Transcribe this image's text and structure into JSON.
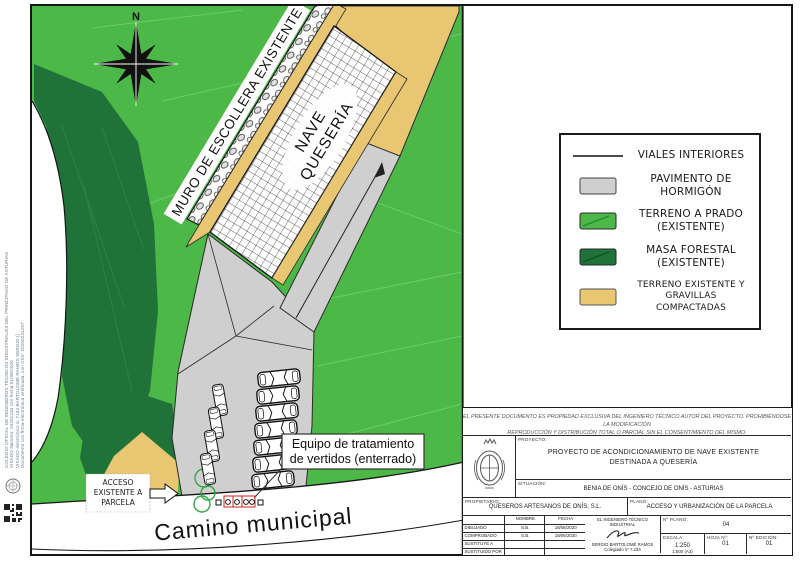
{
  "colors": {
    "prado": "#4cb848",
    "forestal": "#1f7238",
    "gravilla": "#e9c672",
    "hormigon": "#cfcfcf",
    "road": "#ffffff"
  },
  "map": {
    "north_label": "N",
    "muro_label": "MURO DE ESCOLLERA EXISTENTE",
    "nave_line1": "NAVE",
    "nave_line2": "QUESERÍA",
    "equipo_line1": "Equipo de tratamiento",
    "equipo_line2": "de vertidos (enterrado)",
    "acceso_line1": "ACCESO",
    "acceso_line2": "EXISTENTE A",
    "acceso_line3": "PARCELA",
    "camino_label": "Camino municipal"
  },
  "legend": {
    "items": [
      {
        "line1": "VIALES INTERIORES",
        "line2": ""
      },
      {
        "line1": "PAVIMENTO DE",
        "line2": "HORMIGÓN"
      },
      {
        "line1": "TERRENO A PRADO",
        "line2": "(EXISTENTE)"
      },
      {
        "line1": "MASA FORESTAL",
        "line2": "(EXISTENTE)"
      },
      {
        "line1": "TERRENO EXISTENTE Y",
        "line2": "GRAVILLAS COMPACTADAS"
      }
    ]
  },
  "title_block": {
    "disclaimer_line1": "EL PRESENTE DOCUMENTO ES PROPIEDAD EXCLUSIVA DEL INGENIERO TÉCNICO AUTOR DEL PROYECTO. PROHIBIÉNDOSE LA MODIFICACIÓN",
    "disclaimer_line2": "REPRODUCCIÓN Y DISTRIBUCIÓN TOTAL O PARCIAL SIN EL CONSENTIMIENTO DEL MISMO.",
    "proyecto_label": "PROYECTO:",
    "proyecto_line1": "PROYECTO DE ACONDICIONAMIENTO DE NAVE EXISTENTE",
    "proyecto_line2": "DESTINADA A QUESERÍA",
    "situacion_label": "SITUACIÓN:",
    "situacion_value": "BENIA DE ONÍS - CONCEJO DE ONÍS - ASTURIAS",
    "propietario_label": "PROPIETARIO:",
    "propietario_value": "QUESEROS ARTESANOS DE ONÍS, S.L.",
    "plano_label": "PLANO:",
    "plano_value": "ACCESO Y URBANIZACIÓN DE LA PARCELA",
    "col_nombre": "NOMBRE",
    "col_fecha": "FECHA",
    "rows": [
      {
        "label": "DIBUJADO",
        "nombre": "S.B.",
        "fecha": "18/06/2020"
      },
      {
        "label": "COMPROBADO",
        "nombre": "S.B.",
        "fecha": "18/06/2020"
      },
      {
        "label": "SUSTITUYE A",
        "nombre": "",
        "fecha": ""
      },
      {
        "label": "SUSTITUIDO POR",
        "nombre": "",
        "fecha": ""
      }
    ],
    "engineer_title": "EL INGENIERO TÉCNICO INDUSTRIAL",
    "engineer_name": "SERGIO BARTOLOMÉ RAMOS",
    "engineer_number": "Colegiado nº 7.234",
    "num_plano_label": "Nº PLANO:",
    "num_plano_value": "04",
    "escala_label": "ESCALA:",
    "escala_value": "1:250",
    "escala_value2": "1:500 (A3)",
    "hoja_label": "HOJA Nº:",
    "hoja_value": "01",
    "edicion_label": "Nº EDICIÓN:",
    "edicion_value": "01"
  },
  "side_margin": {
    "line1": "COLEGIO OFICIAL DE INGENIEROS TÉCNICOS INDUSTRIALES DEL PRINCIPADO DE ASTURIAS",
    "line2": "VISADO Número: 20201234 con fecha 01/08/2020",
    "line3": "VISADO electrónico a: 7134 BARTOLOMÉ RAMOS SERGIO ()",
    "line4": "Documento con firma electrónica verificada, con CSV: 20200241257"
  }
}
